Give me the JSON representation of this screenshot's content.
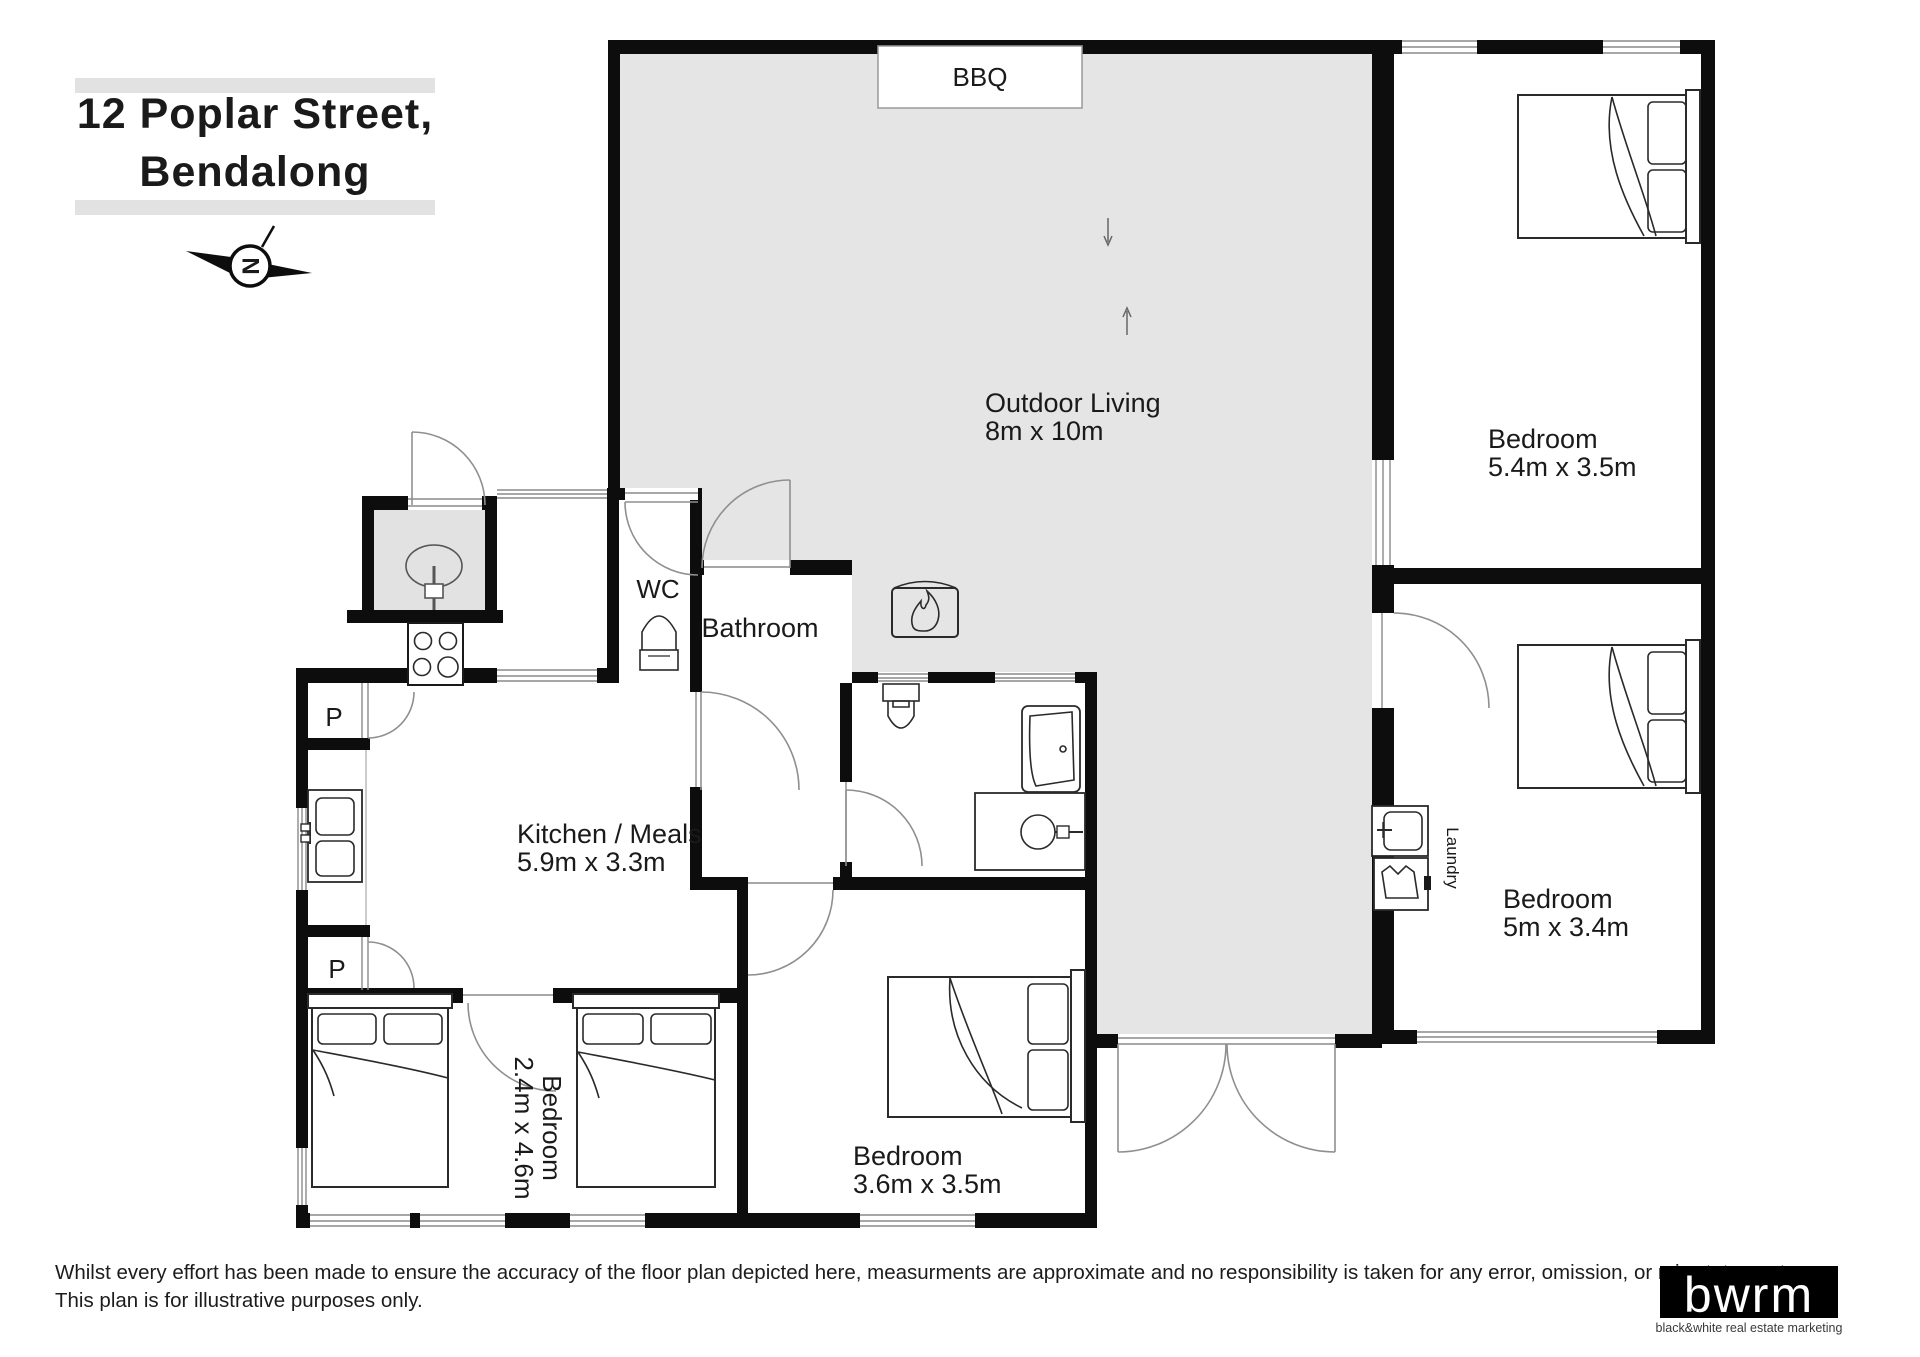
{
  "title": {
    "line1": "12 Poplar Street,",
    "line2": "Bendalong"
  },
  "compass": {
    "north_label": "N"
  },
  "plan": {
    "outdoor_living": {
      "name": "Outdoor Living",
      "dims": "8m x 10m"
    },
    "bbq": {
      "label": "BBQ"
    },
    "bedroom_top_right": {
      "name": "Bedroom",
      "dims": "5.4m x 3.5m"
    },
    "bedroom_right": {
      "name": "Bedroom",
      "dims": "5m x 3.4m"
    },
    "bedroom_middle": {
      "name": "Bedroom",
      "dims": "3.6m x 3.5m"
    },
    "bedroom_left": {
      "name": "Bedroom",
      "dims": "2.4m x 4.6m"
    },
    "kitchen": {
      "name": "Kitchen / Meals",
      "dims": "5.9m x 3.3m"
    },
    "bathroom": {
      "name": "Bathroom"
    },
    "wc": {
      "name": "WC"
    },
    "laundry": {
      "name": "Laundry"
    },
    "pantry_top": {
      "label": "P"
    },
    "pantry_bottom": {
      "label": "P"
    }
  },
  "footer": {
    "disclaimer_line1": "Whilst every effort has been made to ensure the accuracy of the floor plan depicted here, measurments are approximate and no responsibility is taken for any error, omission, or mis statement.",
    "disclaimer_line2": "This plan is for illustrative purposes only."
  },
  "logo": {
    "brand": "bwrm",
    "tagline": "black&white real estate marketing"
  },
  "colors": {
    "wall": "#0d0d0d",
    "outdoor_fill": "#e6e5e5",
    "title_bar": "#e2e2e2",
    "logo_bg": "#000000"
  }
}
